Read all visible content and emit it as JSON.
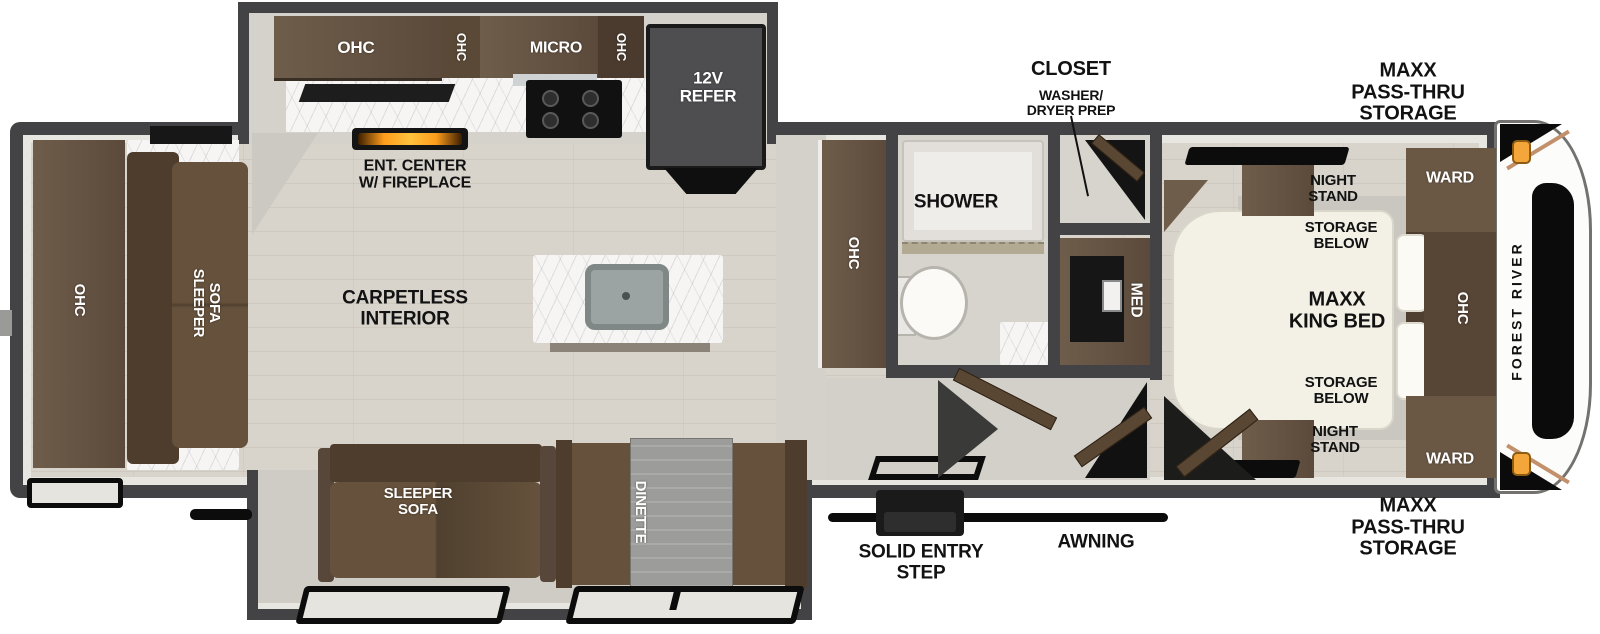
{
  "floorplan": {
    "brand": "FOREST RIVER",
    "labels": {
      "rear_ohc": "OHC",
      "rear_sofa": "SLEEPER\nSOFA",
      "ohc_a": "OHC",
      "ohc_b": "OHC",
      "micro": "MICRO",
      "ohc_c": "OHC",
      "refer": "12V\nREFER",
      "ent_center": "ENT. CENTER\nW/ FIREPLACE",
      "carpetless": "CARPETLESS\nINTERIOR",
      "pantry_ohc": "OHC",
      "shower": "SHOWER",
      "med": "MED",
      "closet_title": "CLOSET",
      "closet_sub": "WASHER/\nDRYER PREP",
      "slide_sofa": "SLEEPER\nSOFA",
      "dinette": "DINETTE",
      "entry_step": "SOLID ENTRY\nSTEP",
      "awning": "AWNING",
      "night_stand_top": "NIGHT\nSTAND",
      "storage_top": "STORAGE\nBELOW",
      "king_bed": "MAXX\nKING BED",
      "storage_bottom": "STORAGE\nBELOW",
      "night_stand_bottom": "NIGHT\nSTAND",
      "ward_top": "WARD",
      "bed_ohc": "OHC",
      "ward_bottom": "WARD",
      "pass_thru_top": "MAXX\nPASS-THRU\nSTORAGE",
      "pass_thru_bottom": "MAXX\nPASS-THRU\nSTORAGE"
    },
    "colors": {
      "wall": "#434345",
      "floor_wood": "#d8d4cc",
      "cabinet_brown": "#6f5d4b",
      "cabinet_dark": "#4e3d2d",
      "sofa_brown": "#66523c",
      "bed_cream": "#f3f0e6",
      "flame_orange": "#ff9d1c",
      "marker_light": "#f4a63b"
    }
  }
}
